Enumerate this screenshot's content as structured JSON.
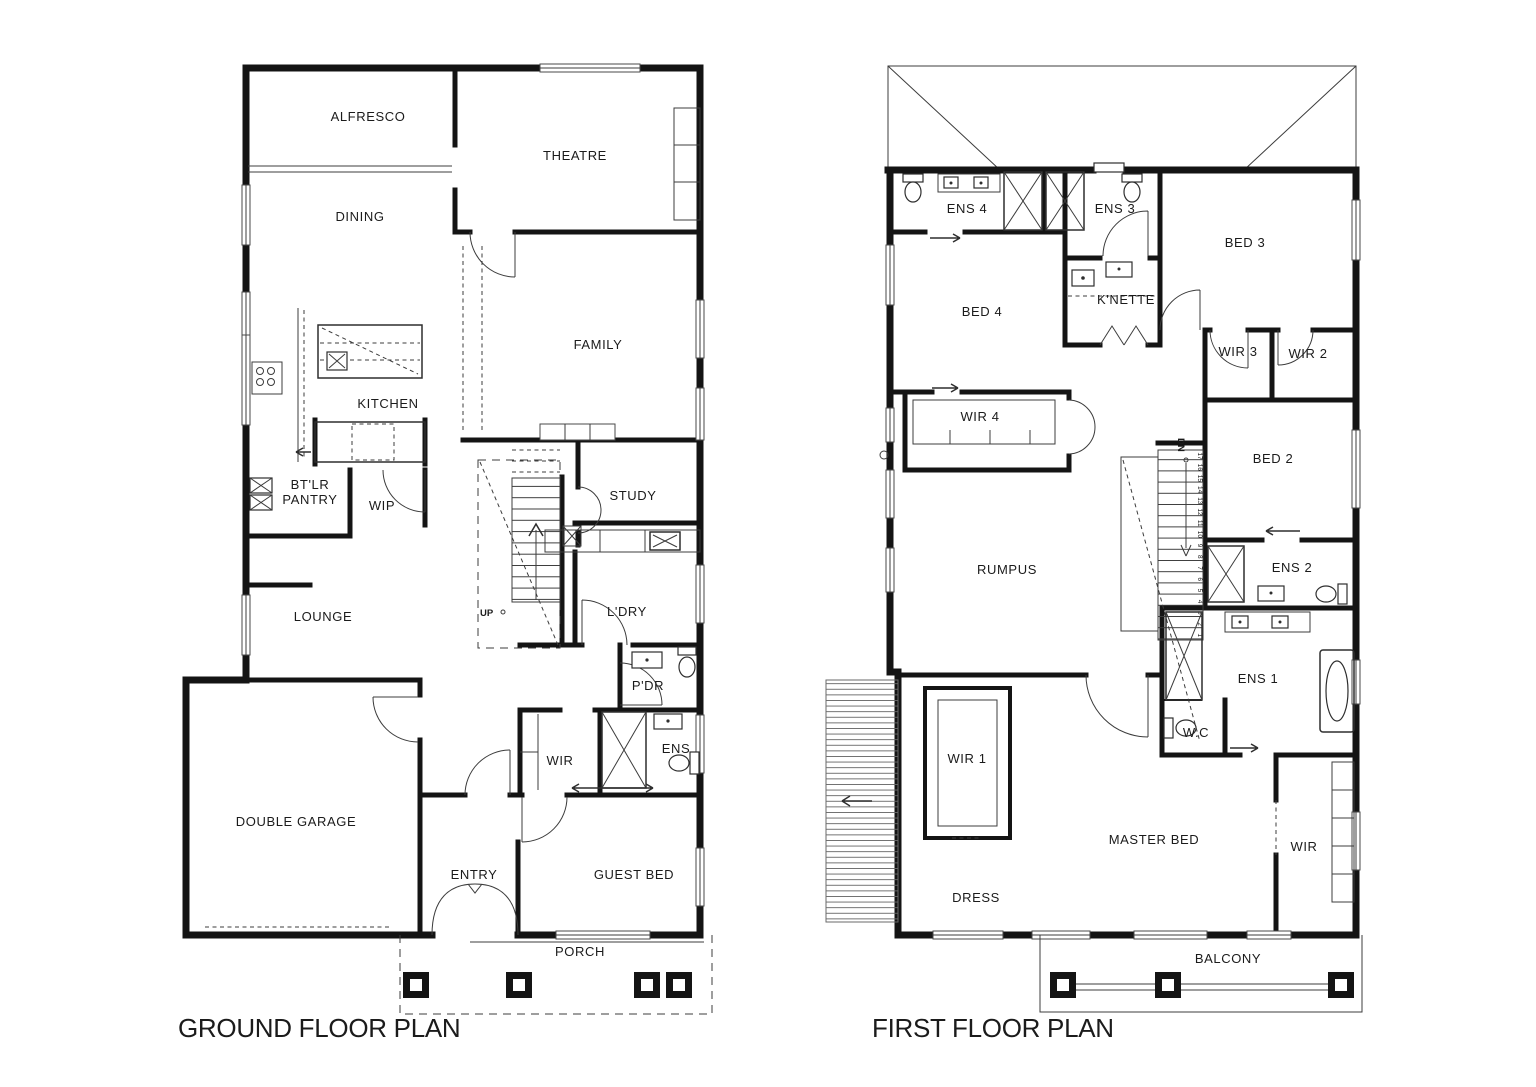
{
  "page": {
    "background": "#ffffff",
    "colors": {
      "wall": "#141414",
      "thin_line": "#3c3c3c",
      "text": "#1b1b1b"
    }
  },
  "ground": {
    "title": "GROUND FLOOR PLAN",
    "labels": {
      "alfresco": "ALFRESCO",
      "theatre": "THEATRE",
      "dining": "DINING",
      "family": "FAMILY",
      "kitchen": "KITCHEN",
      "btlr_line1": "BT'LR",
      "btlr_line2": "PANTRY",
      "wip": "WIP",
      "study": "STUDY",
      "lounge": "LOUNGE",
      "ldry": "L'DRY",
      "pdr": "P'DR",
      "wir": "WIR",
      "ens": "ENS",
      "garage": "DOUBLE GARAGE",
      "entry": "ENTRY",
      "guest_bed": "GUEST BED",
      "porch": "PORCH",
      "up": "UP"
    }
  },
  "first": {
    "title": "FIRST FLOOR PLAN",
    "labels": {
      "ens4": "ENS 4",
      "ens3": "ENS 3",
      "bed3": "BED 3",
      "bed4": "BED 4",
      "knette": "K'NETTE",
      "wir3": "WIR 3",
      "wir2": "WIR 2",
      "wir4": "WIR 4",
      "bed2": "BED 2",
      "rumpus": "RUMPUS",
      "ens2": "ENS 2",
      "ens1": "ENS 1",
      "wc": "W.C",
      "wir1": "WIR 1",
      "master": "MASTER BED",
      "wir": "WIR",
      "dress": "DRESS",
      "balcony": "BALCONY",
      "dn": "DN"
    },
    "stair_numbers": [
      "17",
      "16",
      "15",
      "14",
      "13",
      "12",
      "11",
      "10",
      "9",
      "8",
      "7",
      "6",
      "5",
      "4",
      "3",
      "2",
      "1"
    ]
  }
}
